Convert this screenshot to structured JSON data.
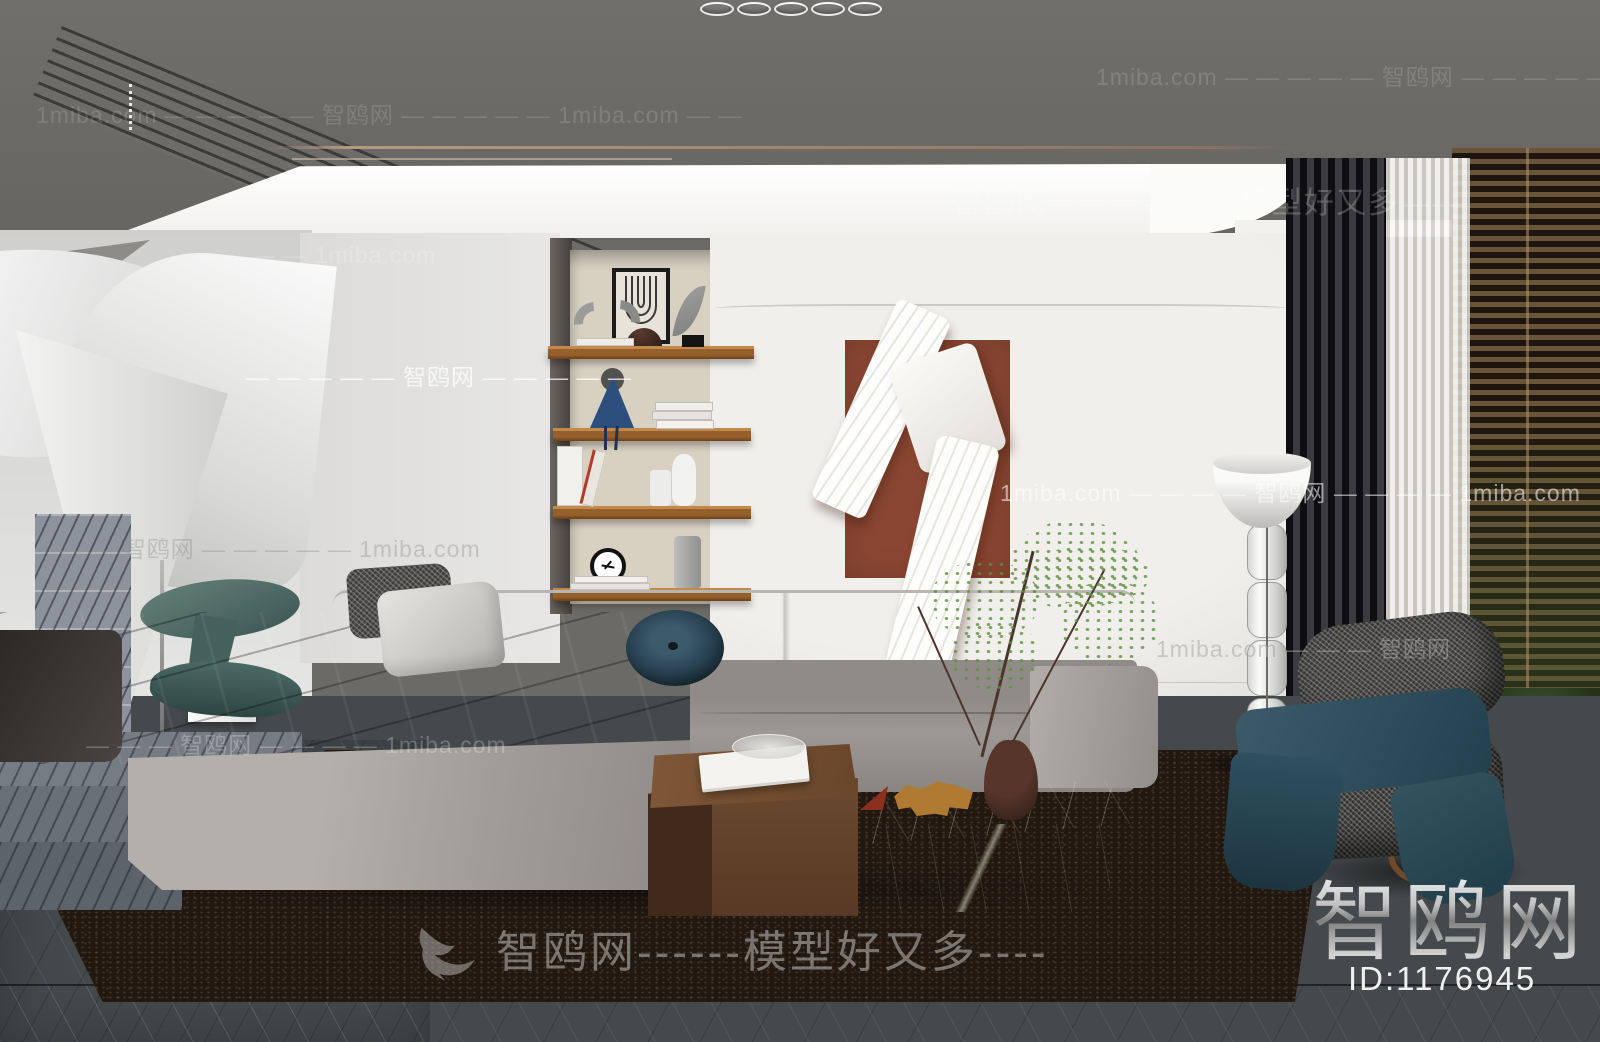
{
  "branding": {
    "logo": "智鸥网",
    "model_id": "ID:1176945"
  },
  "watermarks": {
    "banner": "智鸥网------模型好又多----",
    "ceiling_right": "智鸥网——————模型好又多——",
    "top_left": "1miba.com — — — — — 智鸥网 — — — — — 1miba.com — —",
    "top_right": "1miba.com — — — — — 智鸥网 — — — — —",
    "wall_upper_left": "— — 1miba.com",
    "wall_mid_left": "— — — — — 智鸥网 — — — — —",
    "wall_lower_left": "— — 智鸥网 — — — — — 1miba.com",
    "wall_mid_right": "1miba.com — — — — 智鸥网 — — — — 1miba.com",
    "wall_lower_right": "1miba.com — — — 智鸥网",
    "sofa_row": "— — — 智鸥网 — — — — 1miba.com"
  },
  "colors": {
    "niche-bg": "#d8d1c2",
    "art-rust": "#8a4632",
    "rug-brown": "#231810",
    "marble-green": "#39402a",
    "teal-blanket": "#2e4a57",
    "shelf-wood": "#95602c",
    "blind-brown": "#6a5438"
  }
}
